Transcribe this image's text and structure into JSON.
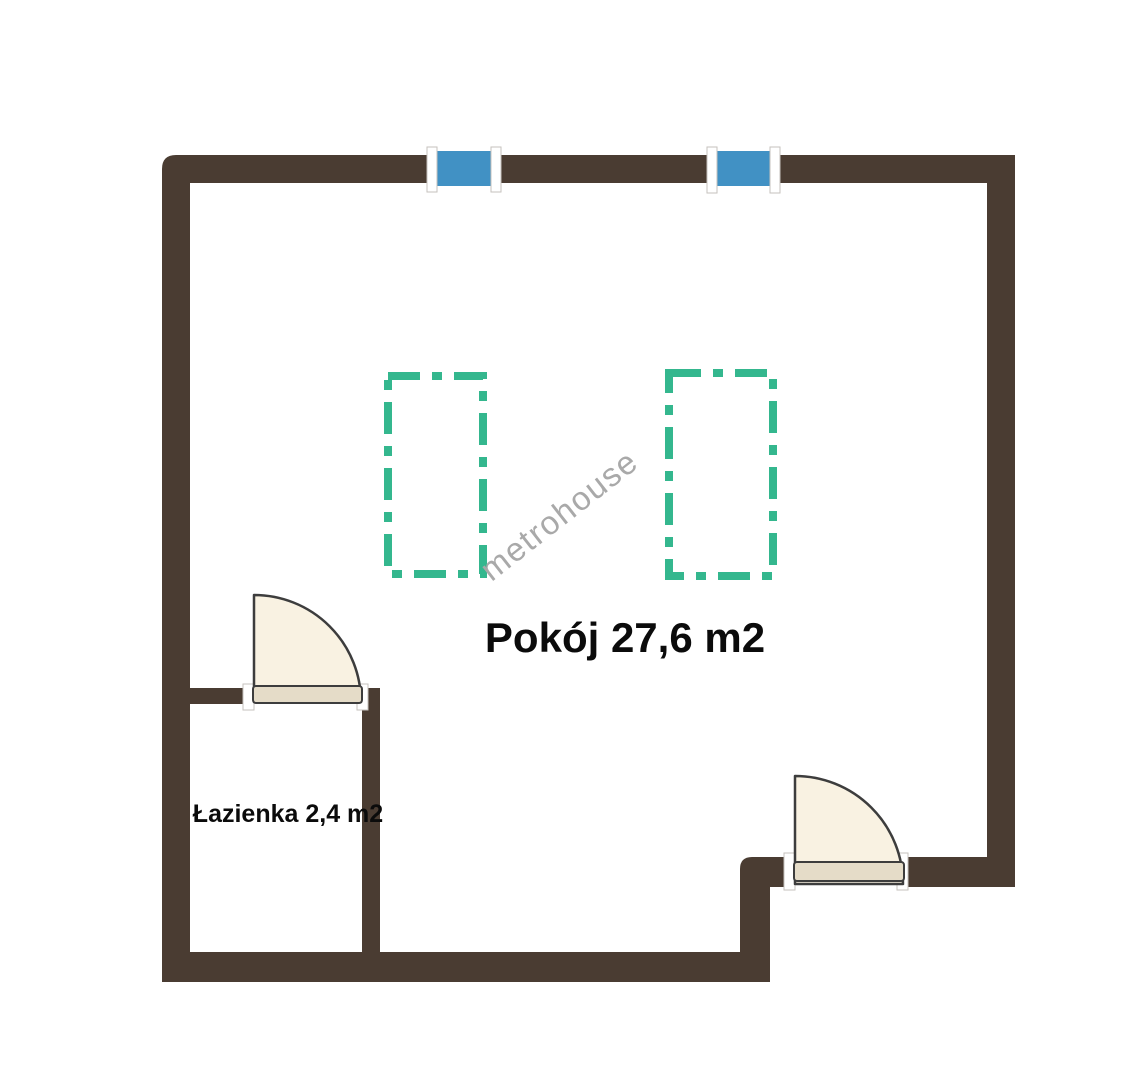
{
  "plan": {
    "type": "floor-plan",
    "watermark": "metrohouse",
    "rooms": {
      "main": {
        "label": "Pokój 27,6 m2",
        "name": "Pokój",
        "area": "27,6 m2"
      },
      "bathroom": {
        "label": "Łazienka 2,4 m2",
        "name": "Łazienka",
        "area": "2,4 m2"
      }
    },
    "features": {
      "windows_count": "2",
      "doors_count": "2",
      "furniture_outlines_count": "2"
    }
  },
  "colors": {
    "background": "#ffffff",
    "wall": "#4a3c32",
    "window_glass": "#4191c4",
    "window_frame": "#ffffff",
    "frame_stroke": "#c6c2bd",
    "furniture": "#34b78e",
    "door_fill": "#f9f2e2",
    "door_panel": "#e5dcc8",
    "door_stroke": "#3d3d3d",
    "label_text": "#0b0b0b",
    "watermark_text": "#a9a9a9"
  }
}
